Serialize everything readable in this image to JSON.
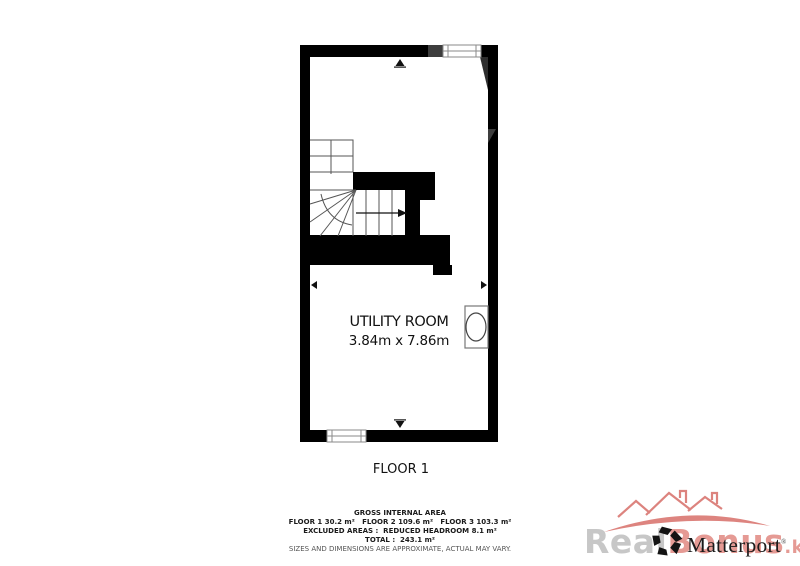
{
  "plan": {
    "room_label": "UTILITY ROOM",
    "room_dimensions": "3.84m x 7.86m",
    "floor_label": "FLOOR 1"
  },
  "footer": {
    "title": "GROSS INTERNAL AREA",
    "floors": "FLOOR 1 30.2 m²   FLOOR 2 109.6 m²   FLOOR 3 103.3 m²",
    "excluded": "EXCLUDED AREAS :  REDUCED HEADROOM 8.1 m²",
    "total": "TOTAL :  243.1 m²",
    "disclaimer": "SIZES AND DIMENSIONS ARE APPROXIMATE, ACTUAL MAY VARY."
  },
  "branding": {
    "name": "Matterport",
    "mark": "®"
  },
  "watermark": {
    "gray_text": "Real",
    "red_text": "Bonus",
    "suffix": ".kz"
  },
  "colors": {
    "wall": "#000000",
    "wall_accent": "#3d3d3d",
    "stair_line": "#555555",
    "watermark_red": "#d4655f",
    "watermark_gray": "#c7c7c7",
    "logo_black": "#141414"
  }
}
